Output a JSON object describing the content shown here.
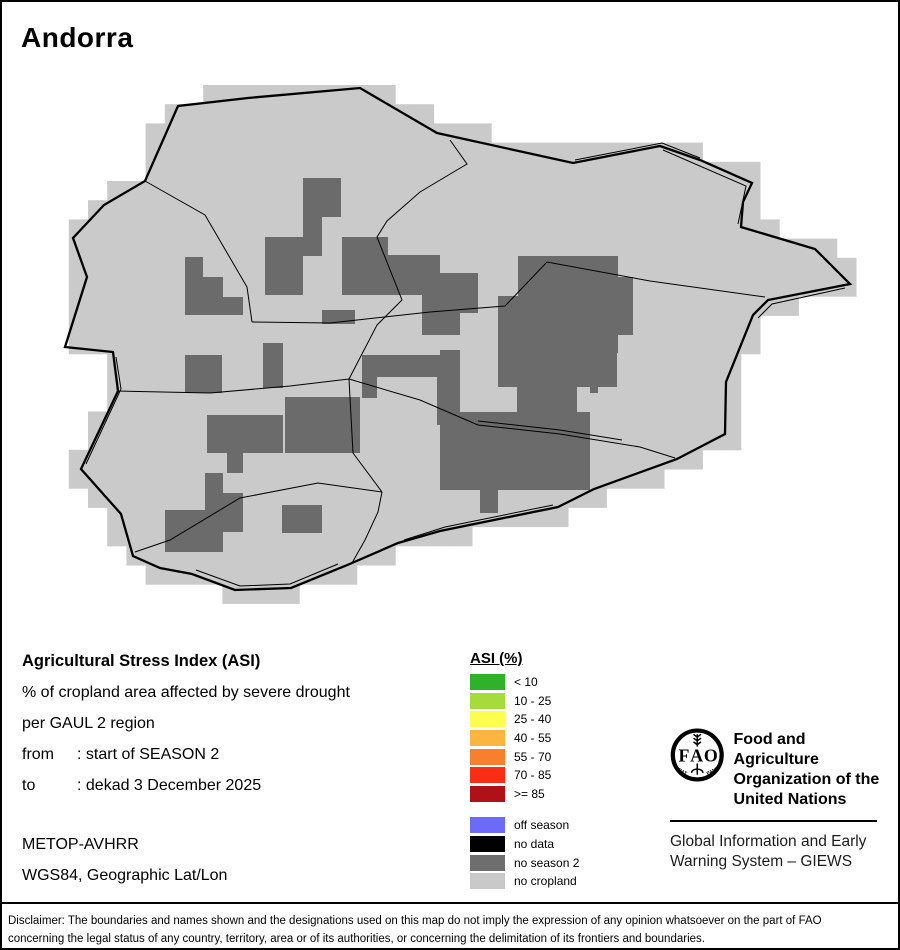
{
  "title": "Andorra",
  "map": {
    "colors": {
      "light": "#cacaca",
      "dark": "#6b6b6b",
      "line": "#000000"
    },
    "grid": {
      "x0": 30.4,
      "y0": 85,
      "cell": 19.2,
      "cols": 43,
      "rows": 27
    },
    "country_outline": [
      [
        248,
        98
      ],
      [
        360,
        88
      ],
      [
        437,
        133
      ],
      [
        573,
        163
      ],
      [
        660,
        146
      ],
      [
        700,
        160
      ],
      [
        752,
        183
      ],
      [
        743,
        202
      ],
      [
        741,
        227
      ],
      [
        815,
        249
      ],
      [
        850,
        284
      ],
      [
        768,
        300
      ],
      [
        753,
        315
      ],
      [
        726,
        382
      ],
      [
        725,
        434
      ],
      [
        677,
        459
      ],
      [
        594,
        489
      ],
      [
        558,
        507
      ],
      [
        440,
        531
      ],
      [
        398,
        543
      ],
      [
        345,
        566
      ],
      [
        291,
        588
      ],
      [
        235,
        590
      ],
      [
        192,
        574
      ],
      [
        160,
        568
      ],
      [
        133,
        556
      ],
      [
        121,
        514
      ],
      [
        81,
        469
      ],
      [
        118,
        391
      ],
      [
        113,
        352
      ],
      [
        65,
        347
      ],
      [
        87,
        277
      ],
      [
        73,
        238
      ],
      [
        104,
        205
      ],
      [
        145,
        181
      ],
      [
        178,
        106
      ]
    ],
    "region_lines": [
      [
        [
          145,
          181
        ],
        [
          205,
          215
        ],
        [
          247,
          287
        ],
        [
          252,
          322
        ]
      ],
      [
        [
          252,
          322
        ],
        [
          330,
          323
        ],
        [
          430,
          312
        ],
        [
          505,
          306
        ],
        [
          547,
          262
        ],
        [
          650,
          281
        ],
        [
          765,
          297
        ]
      ],
      [
        [
          450,
          140
        ],
        [
          467,
          164
        ],
        [
          420,
          192
        ],
        [
          387,
          221
        ],
        [
          377,
          237
        ],
        [
          402,
          300
        ],
        [
          377,
          325
        ],
        [
          349,
          379
        ]
      ],
      [
        [
          349,
          379
        ],
        [
          290,
          386
        ],
        [
          210,
          393
        ],
        [
          118,
          391
        ]
      ],
      [
        [
          349,
          379
        ],
        [
          353,
          453
        ],
        [
          382,
          492
        ]
      ],
      [
        [
          382,
          492
        ],
        [
          378,
          512
        ],
        [
          365,
          540
        ],
        [
          352,
          563
        ]
      ],
      [
        [
          382,
          492
        ],
        [
          318,
          483
        ],
        [
          240,
          498
        ],
        [
          170,
          540
        ],
        [
          135,
          552
        ]
      ],
      [
        [
          349,
          379
        ],
        [
          420,
          400
        ],
        [
          478,
          425
        ],
        [
          560,
          434
        ],
        [
          640,
          447
        ],
        [
          675,
          458
        ]
      ],
      [
        [
          478,
          421
        ],
        [
          560,
          430
        ],
        [
          622,
          440
        ]
      ],
      [
        [
          575,
          160
        ],
        [
          662,
          143
        ],
        [
          700,
          158
        ]
      ],
      [
        [
          663,
          150
        ],
        [
          746,
          186
        ],
        [
          738,
          224
        ]
      ],
      [
        [
          845,
          288
        ],
        [
          772,
          304
        ],
        [
          758,
          318
        ]
      ],
      [
        [
          116,
          357
        ],
        [
          121,
          389
        ],
        [
          86,
          464
        ]
      ],
      [
        [
          338,
          564
        ],
        [
          290,
          584
        ],
        [
          240,
          586
        ],
        [
          196,
          570
        ]
      ],
      [
        [
          553,
          505
        ],
        [
          445,
          527
        ],
        [
          404,
          540
        ]
      ]
    ],
    "dark_patches": [
      [
        303,
        178,
        38,
        39
      ],
      [
        303,
        217,
        19,
        39
      ],
      [
        265,
        237,
        38,
        58
      ],
      [
        342,
        237,
        46,
        58
      ],
      [
        388,
        255,
        52,
        40
      ],
      [
        440,
        273,
        38,
        40
      ],
      [
        422,
        295,
        38,
        40
      ],
      [
        322,
        310,
        33,
        14
      ],
      [
        518,
        256,
        100,
        40
      ],
      [
        498,
        296,
        120,
        57
      ],
      [
        498,
        353,
        119,
        34
      ],
      [
        517,
        387,
        60,
        40
      ],
      [
        617,
        277,
        16,
        58
      ],
      [
        590,
        372,
        8,
        21
      ],
      [
        440,
        350,
        20,
        27
      ],
      [
        440,
        412,
        150,
        78
      ],
      [
        480,
        490,
        18,
        23
      ],
      [
        362,
        355,
        98,
        22
      ],
      [
        362,
        355,
        15,
        43
      ],
      [
        437,
        355,
        23,
        70
      ],
      [
        207,
        415,
        76,
        38
      ],
      [
        227,
        453,
        16,
        20
      ],
      [
        185,
        355,
        37,
        38
      ],
      [
        263,
        343,
        20,
        45
      ],
      [
        285,
        397,
        75,
        56
      ],
      [
        165,
        510,
        58,
        42
      ],
      [
        205,
        473,
        18,
        37
      ],
      [
        223,
        493,
        20,
        39
      ],
      [
        282,
        505,
        40,
        28
      ],
      [
        185,
        257,
        18,
        58
      ],
      [
        203,
        277,
        20,
        38
      ],
      [
        223,
        297,
        20,
        18
      ]
    ]
  },
  "info": {
    "heading": "Agricultural Stress Index (ASI)",
    "line1": "% of cropland area affected by severe drought",
    "line2": "per GAUL 2 region",
    "from_label": "from",
    "from_value": ": start of SEASON 2",
    "to_label": "to",
    "to_value": ": dekad 3 December 2025",
    "sensor": "METOP-AVHRR",
    "projection": "WGS84, Geographic Lat/Lon"
  },
  "legend": {
    "title": "ASI (%)",
    "classes": [
      {
        "label": "< 10",
        "color": "#2db228"
      },
      {
        "label": "10 - 25",
        "color": "#a5dc3c"
      },
      {
        "label": "25 - 40",
        "color": "#fdfd4f"
      },
      {
        "label": "40 - 55",
        "color": "#fcb53e"
      },
      {
        "label": "55 - 70",
        "color": "#f87f2c"
      },
      {
        "label": "70 - 85",
        "color": "#fa2e16"
      },
      {
        "label": ">= 85",
        "color": "#b01116"
      }
    ],
    "extras": [
      {
        "label": "off season",
        "color": "#6b6bf7"
      },
      {
        "label": "no data",
        "color": "#000000"
      },
      {
        "label": "no season 2",
        "color": "#6e6e6e"
      },
      {
        "label": "no cropland",
        "color": "#c9c9c9"
      }
    ]
  },
  "fao": {
    "logo_letters": "FAO",
    "motto_left": "FIAT",
    "motto_right": "PANIS",
    "org_line1": "Food and Agriculture",
    "org_line2": "Organization of the",
    "org_line3": "United Nations",
    "giews_line1": "Global Information and Early",
    "giews_line2": "Warning System – GIEWS"
  },
  "disclaimer": {
    "line1": "Disclaimer: The boundaries and names shown and the designations used on this map do not imply the expression of any opinion whatsoever on the part of FAO",
    "line2": "concerning the legal status of any country, territory, area or of its authorities, or concerning the delimitation of its frontiers and boundaries."
  }
}
